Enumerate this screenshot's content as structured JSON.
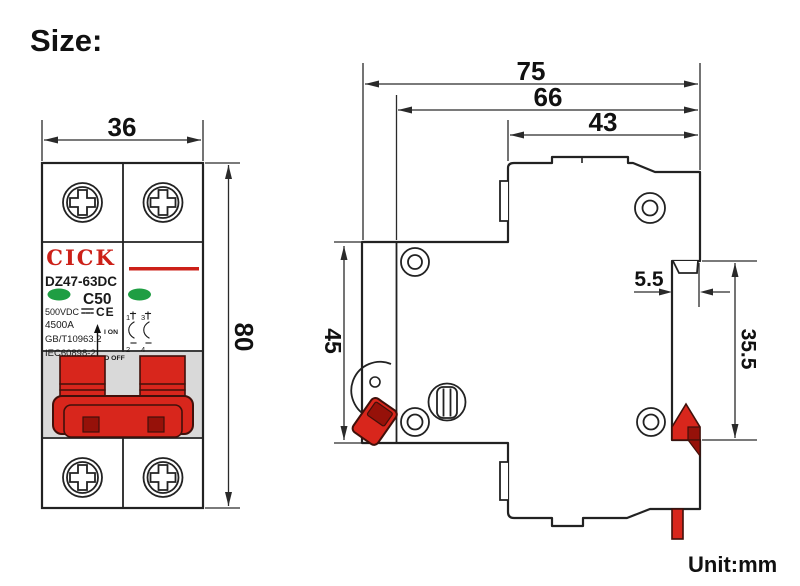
{
  "title": "Size:",
  "unit_label": "Unit:mm",
  "dimensions": {
    "front_width": "36",
    "front_height": "80",
    "side_depth_total": "75",
    "side_depth_body": "66",
    "side_depth_top": "43",
    "front_panel_height": "45",
    "din_notch_depth": "5.5",
    "din_rail_height": "35.5"
  },
  "front_view": {
    "brand": "CICK",
    "model": "DZ47-63DC",
    "curve_rating": "C50",
    "voltage": "500VDC",
    "ce_mark": "CE",
    "breaking_capacity": "4500A",
    "standard_1": "GB/T10963.2",
    "standard_2": "IEC60898-2",
    "on_label": "I ON",
    "off_label": "O OFF",
    "terminal_1": "1",
    "terminal_2": "2",
    "terminal_3": "3",
    "terminal_4": "4"
  },
  "colors": {
    "line": "#222222",
    "red": "#d8261c",
    "dark_red": "#961109",
    "brand_red": "#cc2018",
    "green": "#1f9e43",
    "handle_band_gray": "#d9d9d9"
  }
}
